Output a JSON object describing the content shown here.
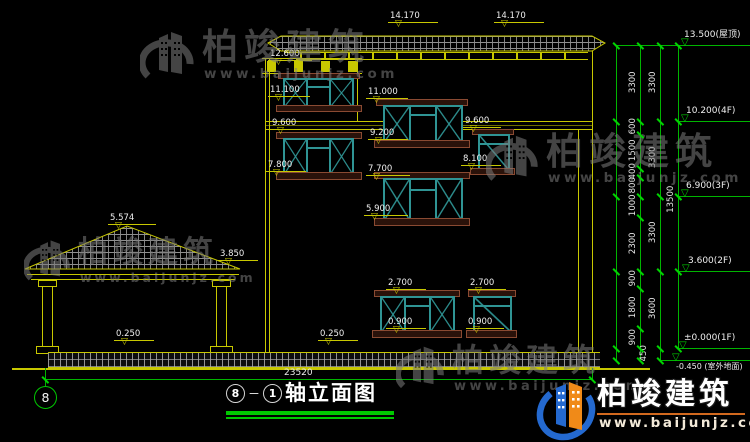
{
  "drawing": {
    "title": "轴立面图",
    "axis_start": "8",
    "axis_end": "1",
    "dash": "－"
  },
  "brand": {
    "name": "柏竣建筑",
    "url": "www.baijunjz.com"
  },
  "marks": [
    "14.170",
    "14.170",
    "12.600",
    "11.100",
    "11.000",
    "9.600",
    "9.200",
    "9.600",
    "8.100",
    "7.800",
    "7.700",
    "5.900",
    "5.574",
    "3.850",
    "2.700",
    "2.700",
    "0.900",
    "0.900",
    "0.250",
    "0.250"
  ],
  "levels": [
    "13.500(屋顶)",
    "10.200(4F)",
    "6.900(3F)",
    "3.600(2F)",
    "±0.000(1F)",
    "-0.450 (室外地面)"
  ],
  "dims": {
    "total_width": "23520",
    "total_height": "13500",
    "floor_heights": [
      "3300",
      "3300",
      "3300",
      "3600"
    ],
    "fine_segments": [
      "3300",
      "600",
      "1500",
      "400",
      "800",
      "1000",
      "2300",
      "900",
      "1800",
      "900",
      "450"
    ]
  },
  "colors": {
    "line_yellow": "#c8c800",
    "dim_green": "#00c800",
    "window_teal": "#2f9494",
    "sill_brown": "#8a4a32",
    "logo_blue": "#2469cf",
    "logo_orange": "#f08a18",
    "background": "#000000"
  }
}
